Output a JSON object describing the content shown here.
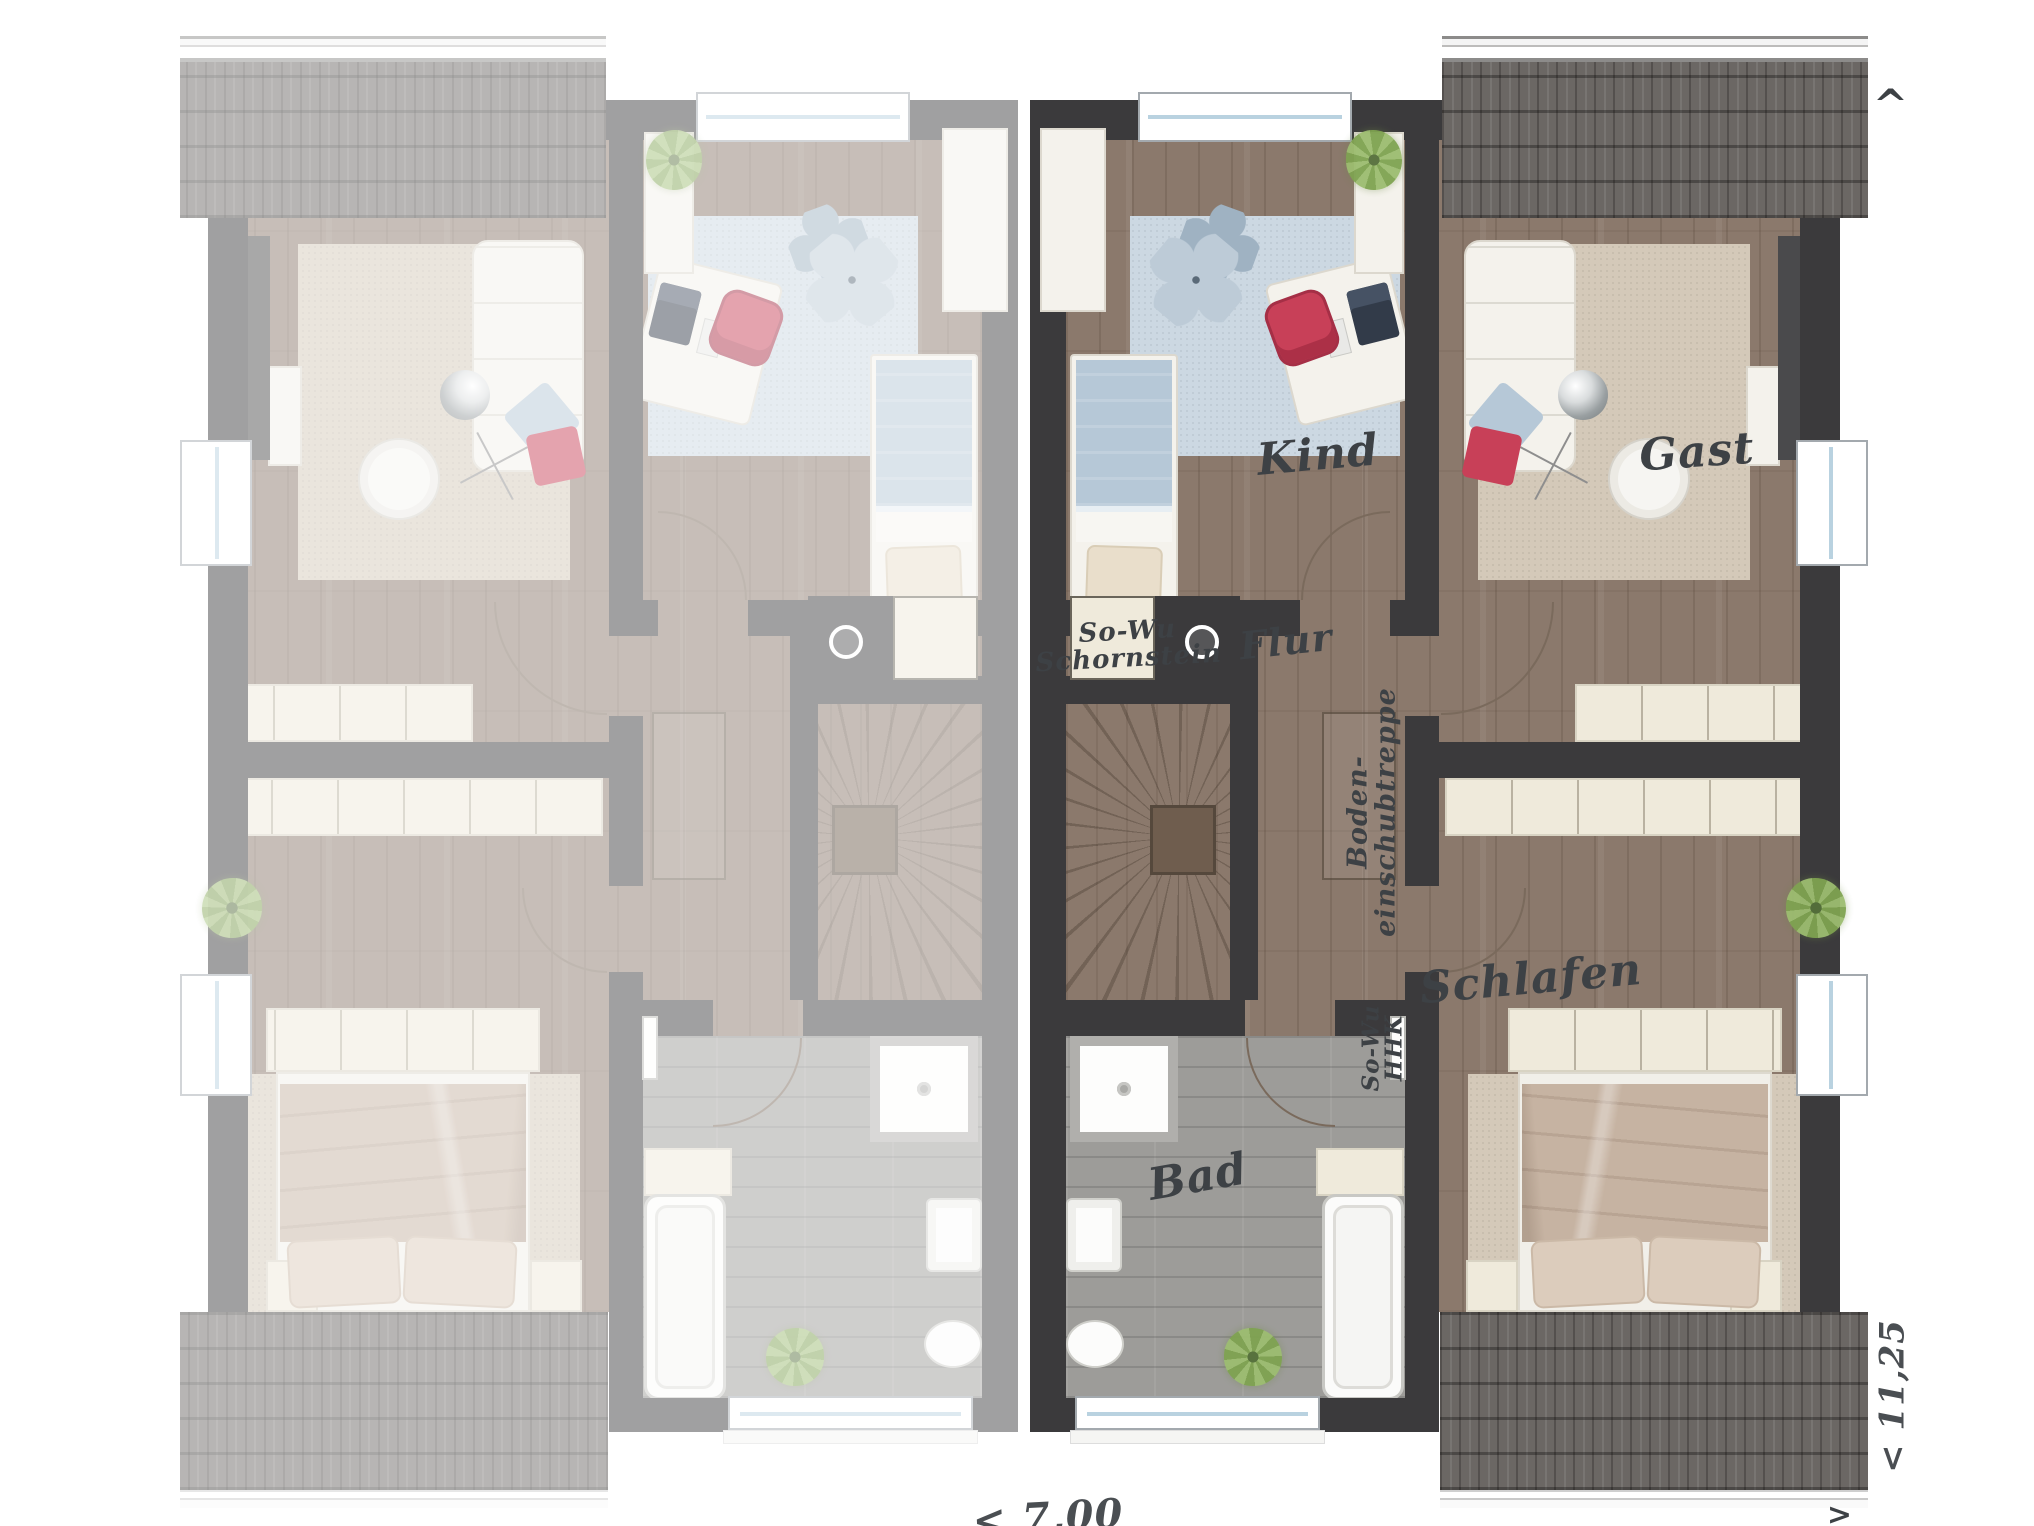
{
  "title": "Dachgeschoss-Grundriss Doppelhaus",
  "labels": {
    "rooms": {
      "kind": "Kind",
      "gast": "Gast",
      "flur": "Flur",
      "schlafen": "Schlafen",
      "bad": "Bad"
    },
    "annotations": {
      "chimney": [
        "So-Wu",
        "Schornstein"
      ],
      "attic_ladder": [
        "Boden-",
        "einschubtreppe"
      ],
      "heater": [
        "So-Wu",
        "HHK"
      ]
    },
    "dimensions": {
      "width": "< 7,00",
      "depth": "< 11,25",
      "arrow_up": "^",
      "arrow_right": ">"
    }
  },
  "colors": {
    "wall": "#3b3a3c",
    "wood": "#8b796c",
    "bad_floor": "#9d9c99",
    "rug_tan": "#d4c9b9",
    "rug_blue": "#ccd8e2",
    "cream": "#efeadb",
    "furniture_white": "#f4f2ec",
    "roof_tile": "#6b6764",
    "accent_red": "#c84058",
    "plant_green": "#7fa351",
    "duvet_blue": "#b6c8d7",
    "duvet_tan": "#c6b3a2",
    "ink": "#3d4145"
  }
}
